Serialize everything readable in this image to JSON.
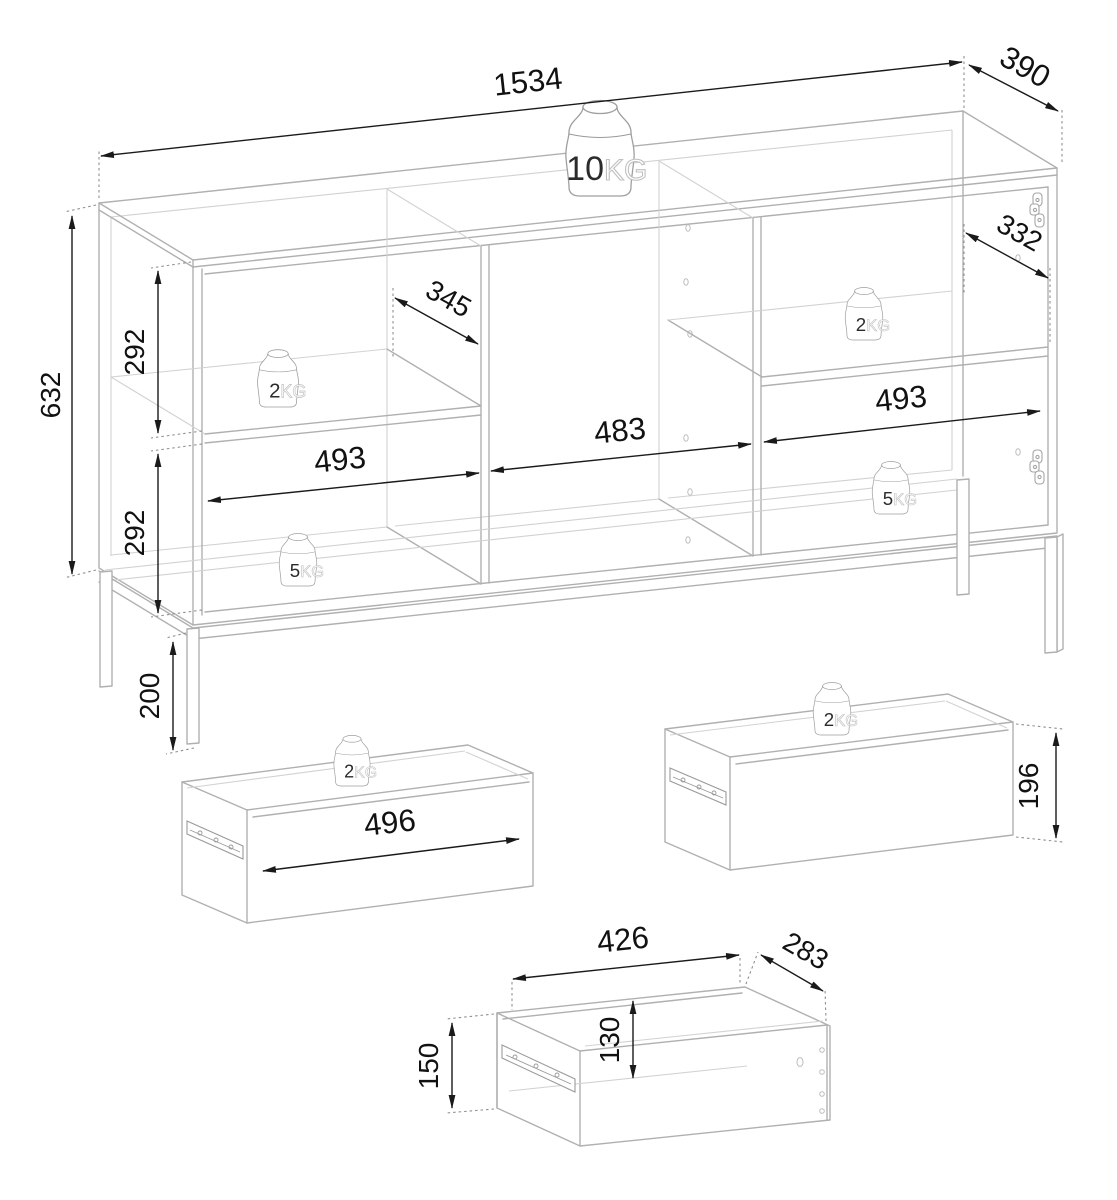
{
  "diagram": {
    "cabinet": {
      "width": "1534",
      "depth": "390",
      "height": "632",
      "upper_compartment_height": "292",
      "lower_compartment_height": "292",
      "leg_height": "200",
      "left_shelf_depth": "345",
      "right_shelf_depth": "332",
      "left_section_width": "493",
      "center_section_width": "483",
      "right_section_width": "493",
      "load_top": {
        "value": "10",
        "unit": "KG"
      },
      "load_left_shelf": {
        "value": "2",
        "unit": "KG"
      },
      "load_left_bottom": {
        "value": "5",
        "unit": "KG"
      },
      "load_right_shelf": {
        "value": "2",
        "unit": "KG"
      },
      "load_right_bottom": {
        "value": "5",
        "unit": "KG"
      }
    },
    "drawer_left": {
      "front_width": "496",
      "load": {
        "value": "2",
        "unit": "KG"
      }
    },
    "drawer_right": {
      "front_height": "196",
      "load": {
        "value": "2",
        "unit": "KG"
      }
    },
    "drawer_small": {
      "width": "426",
      "depth": "283",
      "inner_height": "130",
      "side_height": "150"
    }
  },
  "colors": {
    "outline": "#b0b0b0",
    "dimension": "#1a1a1a",
    "background": "#ffffff"
  }
}
